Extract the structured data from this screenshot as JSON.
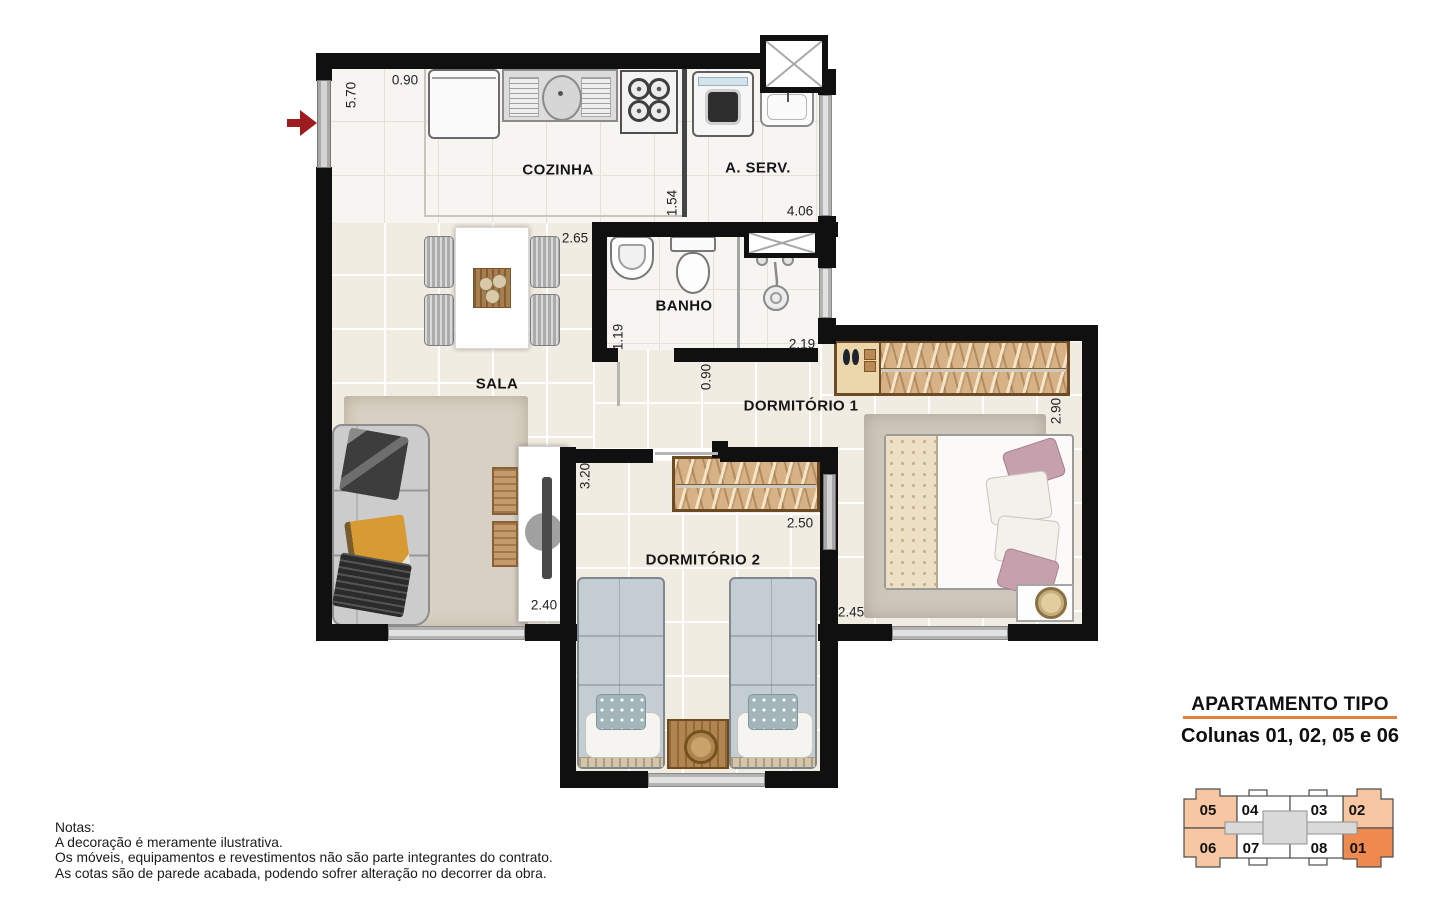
{
  "plan": {
    "rooms": {
      "cozinha": "COZINHA",
      "a_serv": "A. SERV.",
      "banho": "BANHO",
      "sala": "SALA",
      "dormitorio1": "DORMITÓRIO 1",
      "dormitorio2": "DORMITÓRIO 2"
    },
    "dimensions": {
      "left_side": "5.70",
      "entry": "0.90",
      "sala_top": "2.65",
      "cozinha": "1.54",
      "aserv": "4.06",
      "banho_depth": "1.19",
      "banho_width": "2.19",
      "hall": "0.90",
      "dorm1_depth": "2.90",
      "dorm1_width": "2.45",
      "dorm2_depth": "3.20",
      "dorm2_width": "2.50",
      "sala_width": "2.40"
    }
  },
  "notes": {
    "title": "Notas:",
    "lines": [
      "A decoração é meramente ilustrativa.",
      "Os móveis, equipamentos e revestimentos não são parte integrantes do contrato.",
      "As cotas são de parede acabada, podendo sofrer alteração no decorrer da obra."
    ]
  },
  "legend": {
    "title": "APARTAMENTO TIPO",
    "subtitle": "Colunas 01, 02, 05 e 06",
    "units": [
      {
        "label": "05"
      },
      {
        "label": "04"
      },
      {
        "label": "03"
      },
      {
        "label": "02"
      },
      {
        "label": "06"
      },
      {
        "label": "07"
      },
      {
        "label": "08"
      },
      {
        "label": "01"
      }
    ]
  },
  "colors": {
    "accent_orange": "#E0823F",
    "unit_highlight_light": "#F7C6A2",
    "unit_highlight_strong": "#EE8A50",
    "wall": "#101010",
    "entry_arrow": "#9E1B20"
  }
}
